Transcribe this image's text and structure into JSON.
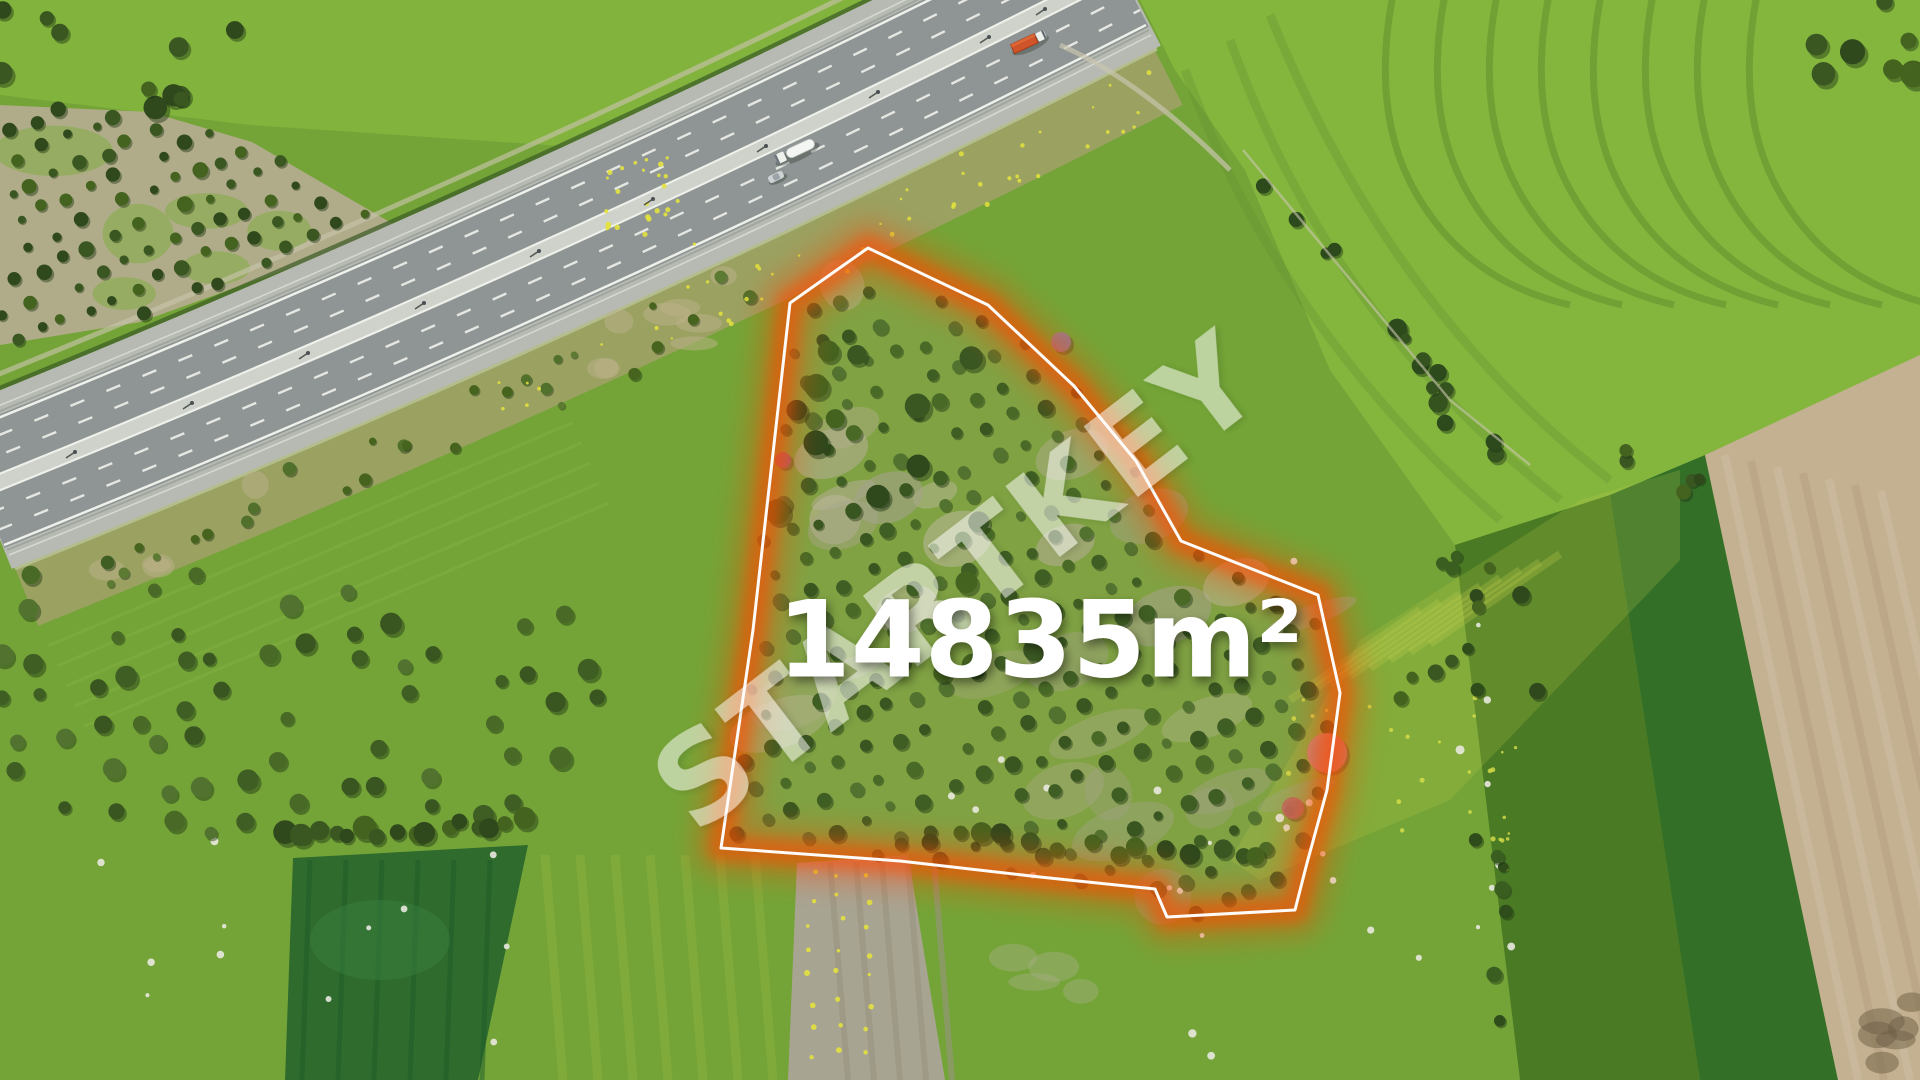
{
  "image": {
    "type": "aerial-drone-photo",
    "subject": "Farmland with an olive-orchard land parcel for sale outlined in red beside a curved dual-carriageway highway"
  },
  "overlay": {
    "watermark": {
      "text": "STARTKEY",
      "color": "#ffffff",
      "opacity": 0.52
    },
    "area_label": {
      "text": "14835m²",
      "color": "#ffffff"
    },
    "parcel_boundary": {
      "line_color": "#ffffff",
      "glow_color": "#ff4a00"
    }
  },
  "scene": {
    "palette": {
      "base_green": "#74a437",
      "bright_green": "#84b63e",
      "deep_green": "#2e6b2d",
      "crop_dark": "#346f28",
      "veg_band": "#4a7a24",
      "tan_field": "#c4b191",
      "harvest_gray": "#a8a492",
      "grove_soil": "#b5ad90",
      "scrub_tan": "#ab9f74",
      "asphalt": "#8f9594",
      "shoulder": "#b6bab3",
      "median": "#ced2cb",
      "line_white": "#eef0ea",
      "boundary_white": "#ffffff",
      "glow_orange": "#ff4a00",
      "watermark_white": "#ffffff",
      "label_white": "#ffffff",
      "truck_orange": "#d0542a",
      "tree_dark": "#3c5c22",
      "rock_white": "#e9e9df",
      "flower_yellow": "#e3e23e",
      "pink_tree": "#c8857b"
    },
    "vehicles": [
      {
        "name": "tanker-truck",
        "body_color": "#f2f4f1"
      },
      {
        "name": "passenger-car",
        "body_color": "#cdd2d4"
      },
      {
        "name": "container-truck",
        "body_color": "#d0542a"
      }
    ]
  }
}
